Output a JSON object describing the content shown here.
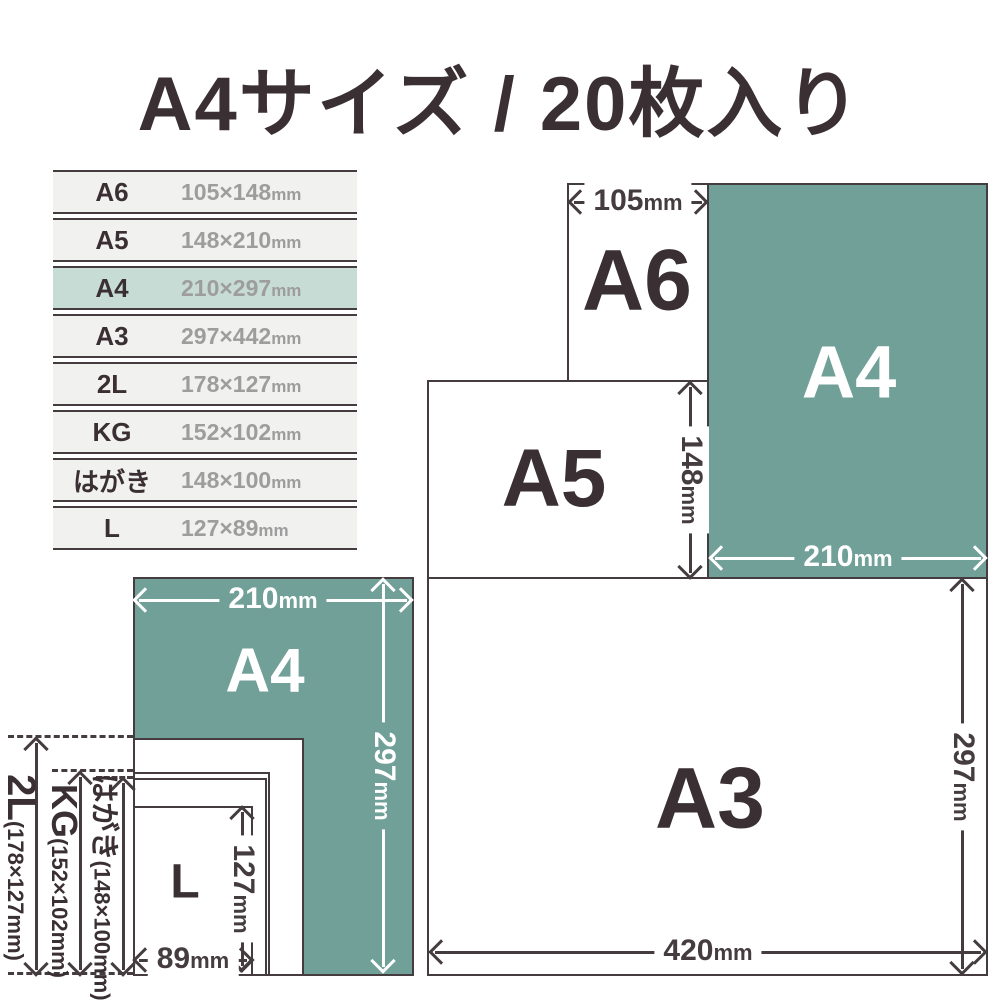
{
  "title": "A4サイズ / 20枚入り",
  "colors": {
    "accent_teal": "#70a098",
    "highlight_row": "#c7dcd5",
    "text_dark": "#3a2f33",
    "text_gray": "#9d9d9d"
  },
  "size_table": {
    "rows": [
      {
        "name": "A6",
        "value": "105×148",
        "unit": "mm",
        "highlighted": false
      },
      {
        "name": "A5",
        "value": "148×210",
        "unit": "mm",
        "highlighted": false
      },
      {
        "name": "A4",
        "value": "210×297",
        "unit": "mm",
        "highlighted": true
      },
      {
        "name": "A3",
        "value": "297×442",
        "unit": "mm",
        "highlighted": false
      },
      {
        "name": "2L",
        "value": "178×127",
        "unit": "mm",
        "highlighted": false
      },
      {
        "name": "KG",
        "value": "152×102",
        "unit": "mm",
        "highlighted": false
      },
      {
        "name": "はがき",
        "value": "148×100",
        "unit": "mm",
        "highlighted": false
      },
      {
        "name": "L",
        "value": "127×89",
        "unit": "mm",
        "highlighted": false
      }
    ]
  },
  "diagram_top_right": {
    "a6": {
      "label": "A6",
      "width": "105",
      "width_unit": "mm"
    },
    "a4": {
      "label": "A4",
      "width": "210",
      "width_unit": "mm"
    },
    "a5": {
      "label": "A5",
      "height": "148",
      "height_unit": "mm"
    },
    "a3": {
      "label": "A3",
      "width": "420",
      "width_unit": "mm",
      "height": "297",
      "height_unit": "mm"
    }
  },
  "diagram_bottom_left": {
    "a4": {
      "label": "A4",
      "width": "210",
      "width_unit": "mm",
      "height": "297",
      "height_unit": "mm"
    },
    "l": {
      "label": "L",
      "width": "89",
      "width_unit": "mm",
      "height": "127",
      "height_unit": "mm"
    },
    "side_labels": {
      "l2": {
        "name": "2L",
        "dims": "(178×127mm)"
      },
      "kg": {
        "name": "KG",
        "dims": "(152×102mm)"
      },
      "hagaki": {
        "name": "はがき",
        "dims": "(148×100mm)"
      }
    }
  }
}
